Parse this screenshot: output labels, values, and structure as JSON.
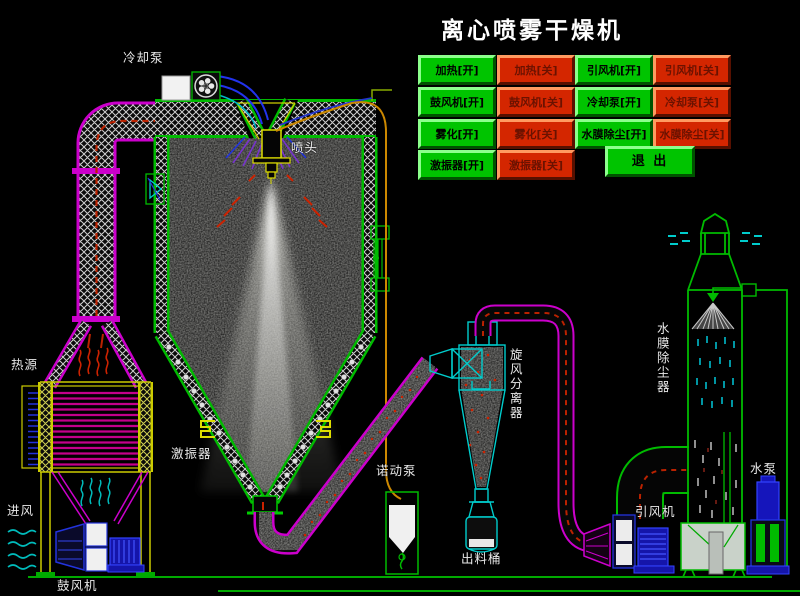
{
  "title": "离心喷雾干燥机",
  "control_panel": {
    "buttons": [
      {
        "label": "加热[开]",
        "state": "on"
      },
      {
        "label": "加热[关]",
        "state": "off"
      },
      {
        "label": "引风机[开]",
        "state": "on"
      },
      {
        "label": "引风机[关]",
        "state": "off"
      },
      {
        "label": "鼓风机[开]",
        "state": "on"
      },
      {
        "label": "鼓风机[关]",
        "state": "off"
      },
      {
        "label": "冷却泵[开]",
        "state": "on"
      },
      {
        "label": "冷却泵[关]",
        "state": "off"
      },
      {
        "label": "雾化[开]",
        "state": "on"
      },
      {
        "label": "雾化[关]",
        "state": "off"
      },
      {
        "label": "水膜除尘[开]",
        "state": "on"
      },
      {
        "label": "水膜除尘[关]",
        "state": "off"
      },
      {
        "label": "激振器[开]",
        "state": "on"
      },
      {
        "label": "激振器[关]",
        "state": "off"
      }
    ],
    "exit_label": "退 出"
  },
  "diagram_labels": {
    "cooling_pump": "冷却泵",
    "spray_head": "喷头",
    "heat_source": "热源",
    "air_inlet": "进风",
    "blower": "鼓风机",
    "vibrator": "激振器",
    "peristaltic_pump": "诺动泵",
    "discharge_barrel": "出料桶",
    "cyclone_separator": "旋风分离器",
    "induced_draft_fan": "引风机",
    "water_film_dust_collector": "水膜除尘器",
    "water_pump": "水泵"
  },
  "colors": {
    "background": "#000000",
    "title_text": "#ffffff",
    "button_on": "#00c400",
    "button_off": "#d42600",
    "button_on_text": "#000000",
    "button_off_text": "#6b1200",
    "pipe_magenta": "#cc00cc",
    "structure_green": "#00bb00",
    "cyan_lines": "#00cccc",
    "yellow_frame": "#cccc00",
    "flow_dash_red": "#bb2200",
    "fan_blue": "#2233dd",
    "feed_line_orange": "#cc8800",
    "label_text": "#e8e8e8"
  }
}
